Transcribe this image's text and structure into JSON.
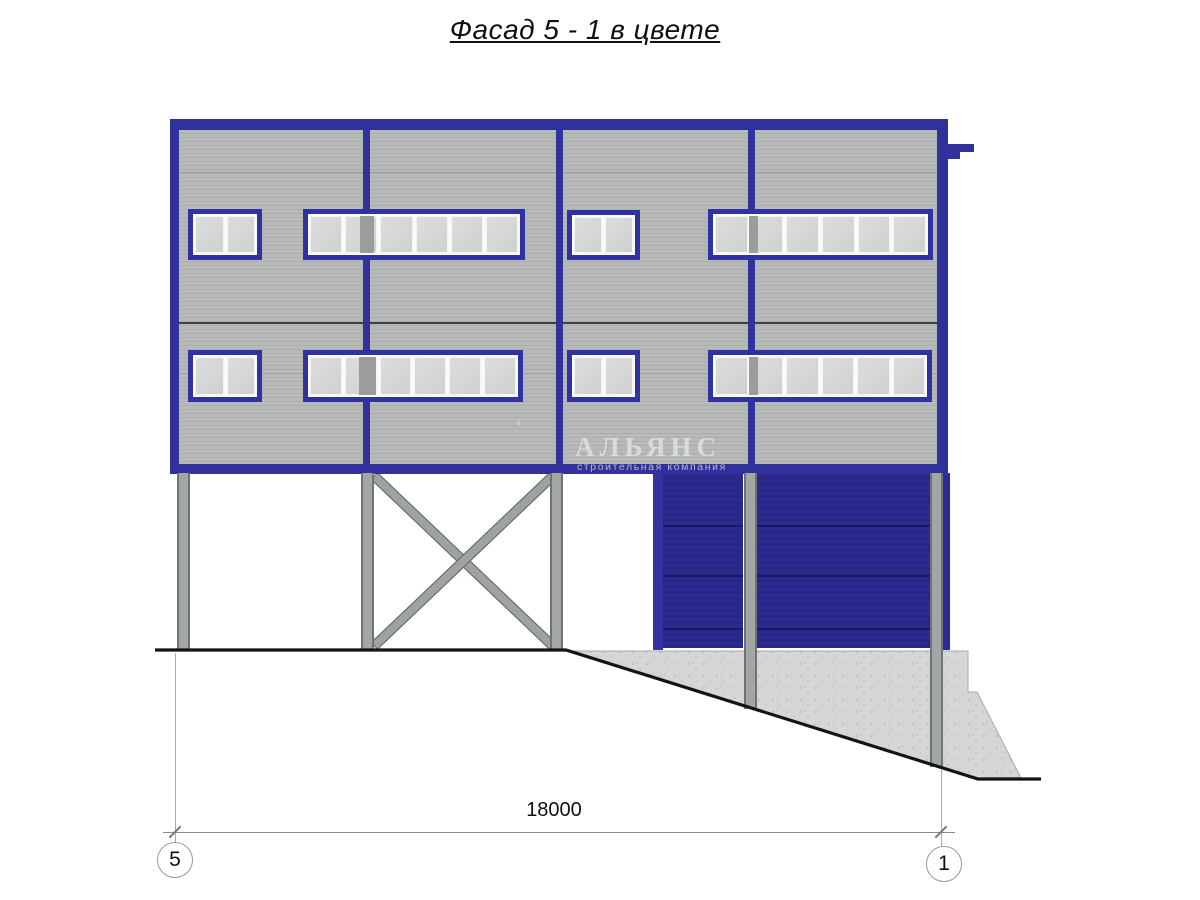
{
  "page": {
    "title": "Фасад 5 - 1 в цвете"
  },
  "watermark": {
    "logo_icon": "sail-logo-icon",
    "company": "АЛЬЯНС",
    "tagline": "строительная компания"
  },
  "dimension": {
    "value": "18000",
    "axis_left": "5",
    "axis_right": "1"
  },
  "colors": {
    "frame_blue": "#31319b",
    "window_frame_blue": "#3132a2",
    "gate_navy": "#28288c",
    "gate_frame_blue": "#3434a0",
    "siding_gray": "#b5b8b7",
    "column_gray": "#9ea2a1",
    "concrete_gray": "#d5d6d5",
    "ground_black": "#141414"
  }
}
